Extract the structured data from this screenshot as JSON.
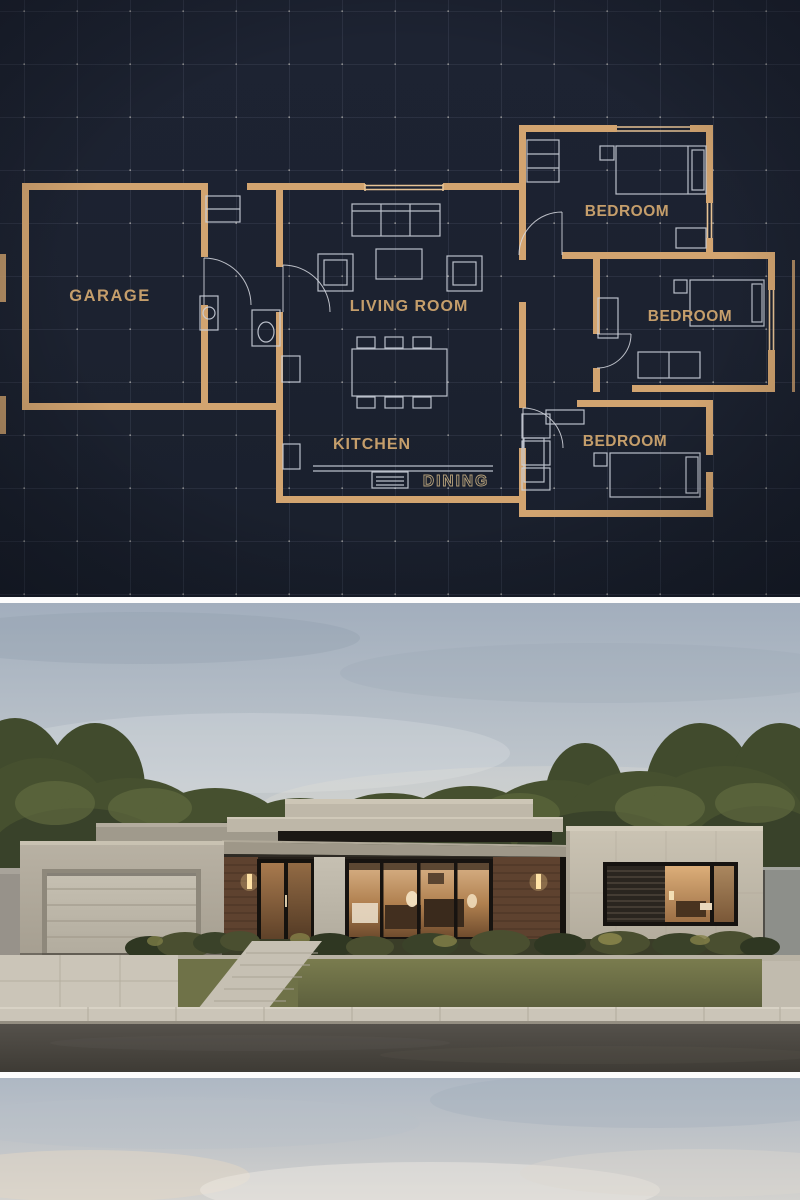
{
  "blueprint": {
    "labels": {
      "garage": "GARAGE",
      "living_room": "LIVING ROOM",
      "kitchen": "KITCHEN",
      "dining": "DINING",
      "bedroom_top": "BEDROOM",
      "bedroom_middle": "BEDROOM",
      "bedroom_bottom": "BEDROOM"
    },
    "colors": {
      "background": "#1c2230",
      "grid": "#5c6478",
      "grid_dot": "#e9e5da",
      "wall": "#d2a470",
      "wall_light": "#e8c folle",
      "wall_highlight": "#e6c294",
      "furniture_line": "#ccd1db",
      "label_text": "#c59e6b",
      "dining_outline": "#b5a07a"
    }
  },
  "render": {
    "colors": {
      "sky_top": "#a2aebd",
      "sky_horizon": "#ded9cf",
      "trees_dark": "#39422a",
      "trees_mid": "#46502f",
      "trees_light": "#5f6a3e",
      "concrete_light": "#cac3b3",
      "concrete_mid": "#beb7a8",
      "concrete_dark": "#a09a8c",
      "wood_cladding": "#5e422f",
      "window_frame": "#171310",
      "window_glow": "#cf9c64",
      "sconce_glow": "#ffe3a6",
      "garage_door": "#c0baac",
      "lawn": "#6d7147",
      "pavement": "#cbc5b8",
      "road": "#49453f",
      "fence": "#8d8f8a"
    }
  },
  "footer": {
    "colors": {
      "sky_top": "#aeb8c4",
      "sky_bottom": "#d3d2cf"
    }
  }
}
